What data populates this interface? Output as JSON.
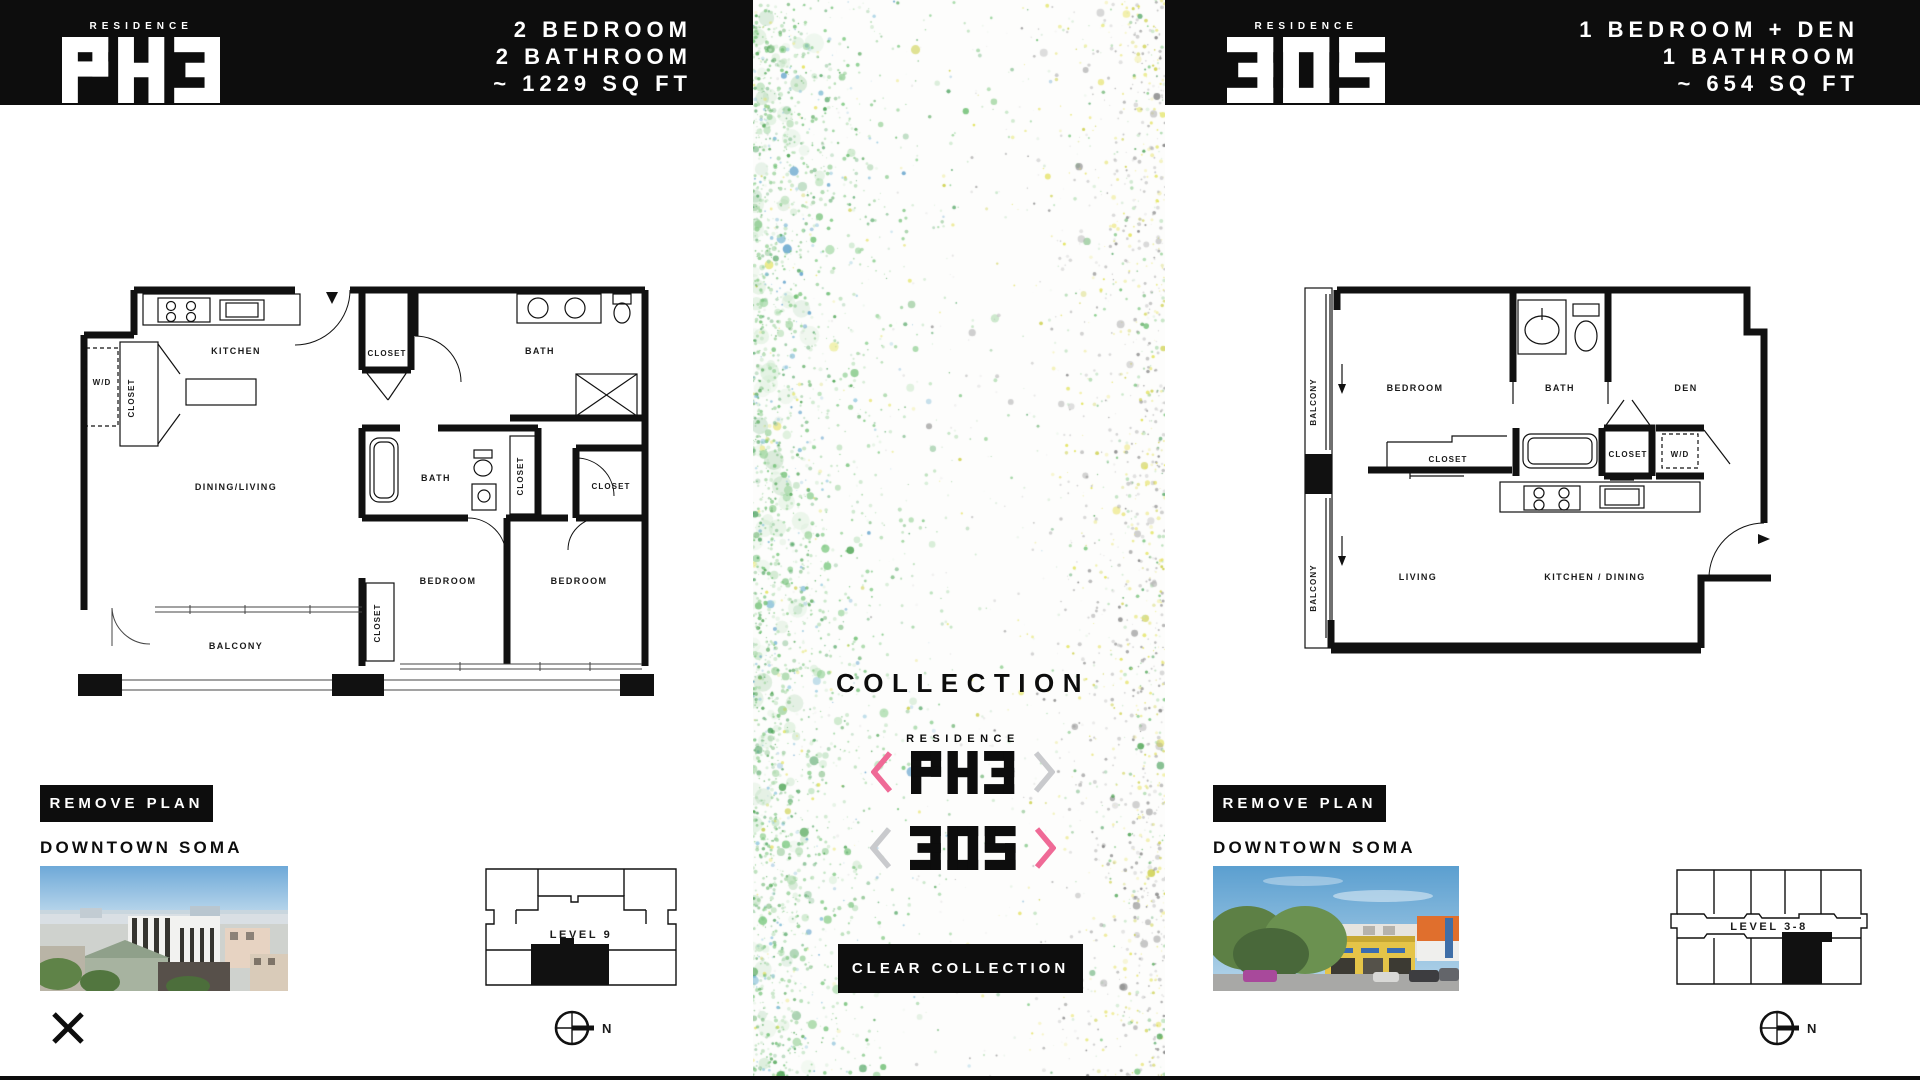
{
  "left_panel": {
    "brand": "RESIDENCE",
    "unit": "PH3",
    "specs": {
      "line1": "2 BEDROOM",
      "line2": "2 BATHROOM",
      "line3": "~ 1229 SQ FT"
    },
    "remove_plan": "REMOVE PLAN",
    "neighborhood": "DOWNTOWN SOMA",
    "neighborhood_photo": "aerial view of Downtown SoMa rooftops",
    "level": "LEVEL 9",
    "north": "N",
    "rooms": {
      "wd": "W/D",
      "closet_kitchen": "CLOSET",
      "kitchen": "KITCHEN",
      "closet_entry": "CLOSET",
      "bath_master": "BATH",
      "dining_living": "DINING/LIVING",
      "bath2": "BATH",
      "closet_bath": "CLOSET",
      "closet_right": "CLOSET",
      "bedroom1": "BEDROOM",
      "bedroom2": "BEDROOM",
      "closet_bedroom": "CLOSET",
      "balcony": "BALCONY"
    }
  },
  "middle": {
    "title": "COLLECTION",
    "brand": "RESIDENCE",
    "item1": "PH3",
    "item2": "305",
    "clear": "CLEAR COLLECTION"
  },
  "right_panel": {
    "brand": "RESIDENCE",
    "unit": "305",
    "specs": {
      "line1": "1 BEDROOM + DEN",
      "line2": "1 BATHROOM",
      "line3": "~ 654 SQ FT"
    },
    "remove_plan": "REMOVE PLAN",
    "neighborhood": "DOWNTOWN SOMA",
    "neighborhood_photo": "street view of Downtown SoMa with trees and yellow storefront",
    "level": "LEVEL 3-8",
    "north": "N",
    "rooms": {
      "balcony": "BALCONY",
      "bedroom": "BEDROOM",
      "bath": "BATH",
      "den": "DEN",
      "closet_long": "CLOSET",
      "closet_small": "CLOSET",
      "wd": "W/D",
      "living": "LIVING",
      "kitchen_dining": "KITCHEN / DINING"
    }
  },
  "colors": {
    "accent_pink": "#ef6a96",
    "chevron_gray": "#c9cacd",
    "header_black": "#0d0d0d",
    "speckle_green": "#6fbf73",
    "speckle_yellow": "#dfe04a"
  }
}
